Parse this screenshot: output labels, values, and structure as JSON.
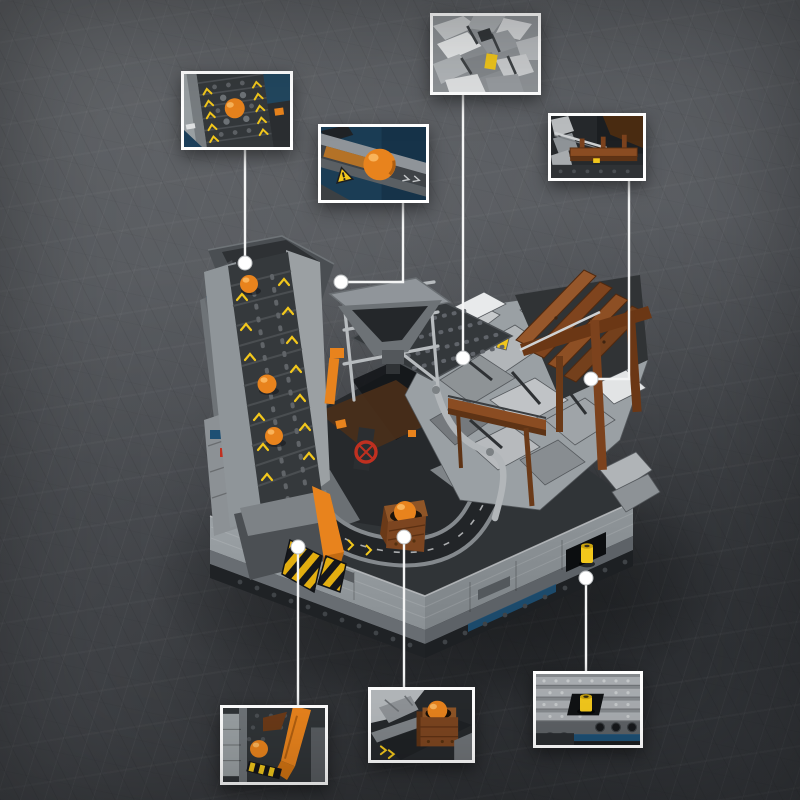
{
  "image": {
    "type": "product-photo",
    "subject": "grey brick-built mining quarry diorama with motorised inclined ball conveyor, rock cliff, wooden mine structures and orange marble balls",
    "background": "dark scratched concrete surface",
    "visible_text": "none"
  },
  "palette": {
    "bg": "#595c60",
    "bg-dark": "#404348",
    "frame": "#ffffff",
    "leader": "#f4f5f5",
    "brick-light": "#a9adb0",
    "brick-mid": "#8b9094",
    "brick-dark": "#55595d",
    "belt": "#34383b",
    "near-black": "#1e2124",
    "orange": "#e8831d",
    "orange-hi": "#f9b35a",
    "yellow": "#f2c71c",
    "hazard-yellow": "#e3ae10",
    "brown": "#8a4c22",
    "brown-light": "#a05c2c",
    "brown-dark": "#5e3315",
    "blue": "#1d4f73",
    "red": "#c03020"
  },
  "model": {
    "features": [
      "inclined-ball-conveyor-with-chevrons",
      "top-hood-platform",
      "hopper-on-scaffold",
      "dark-mesh-ramp",
      "rock-cliff-rubble",
      "wooden-plank-lean-to-roof",
      "wooden-walkway-trough",
      "curved-ground-ball-track",
      "ball-crate",
      "hazard-striped-ramp",
      "orange-chute-arm",
      "grey-base-plinth",
      "yellow-crank-recess"
    ],
    "conveyor_ball_count": 3,
    "ball_color_name": "orange"
  },
  "callouts": [
    {
      "id": "conveyor-belt-closeup",
      "corner": "top-left",
      "label": "Close-up: studded conveyor belt with orange ball and yellow chevron arrows"
    },
    {
      "id": "ball-chute-closeup",
      "corner": "top-center",
      "label": "Close-up: orange ball on grey chute with yellow warning triangle"
    },
    {
      "id": "rock-rubble-closeup",
      "corner": "top-right",
      "label": "Close-up: light grey rock rubble slabs with small yellow brick"
    },
    {
      "id": "wooden-trough-closeup",
      "corner": "upper-right",
      "label": "Close-up: brown wooden mine trough with silver rod"
    },
    {
      "id": "corner-mechanism-closeup",
      "corner": "bottom-left",
      "label": "Close-up: orange arm, orange ball and hazard stripes at base corner"
    },
    {
      "id": "ball-crate-closeup",
      "corner": "bottom-center",
      "label": "Close-up: brown crate holding an orange ball on the track"
    },
    {
      "id": "crank-handle-closeup",
      "corner": "bottom-right",
      "label": "Close-up: yellow crank handle recessed in the base side wall"
    }
  ],
  "markers": {
    "dot_count": 7,
    "style": "white dot with thin white leader line"
  }
}
